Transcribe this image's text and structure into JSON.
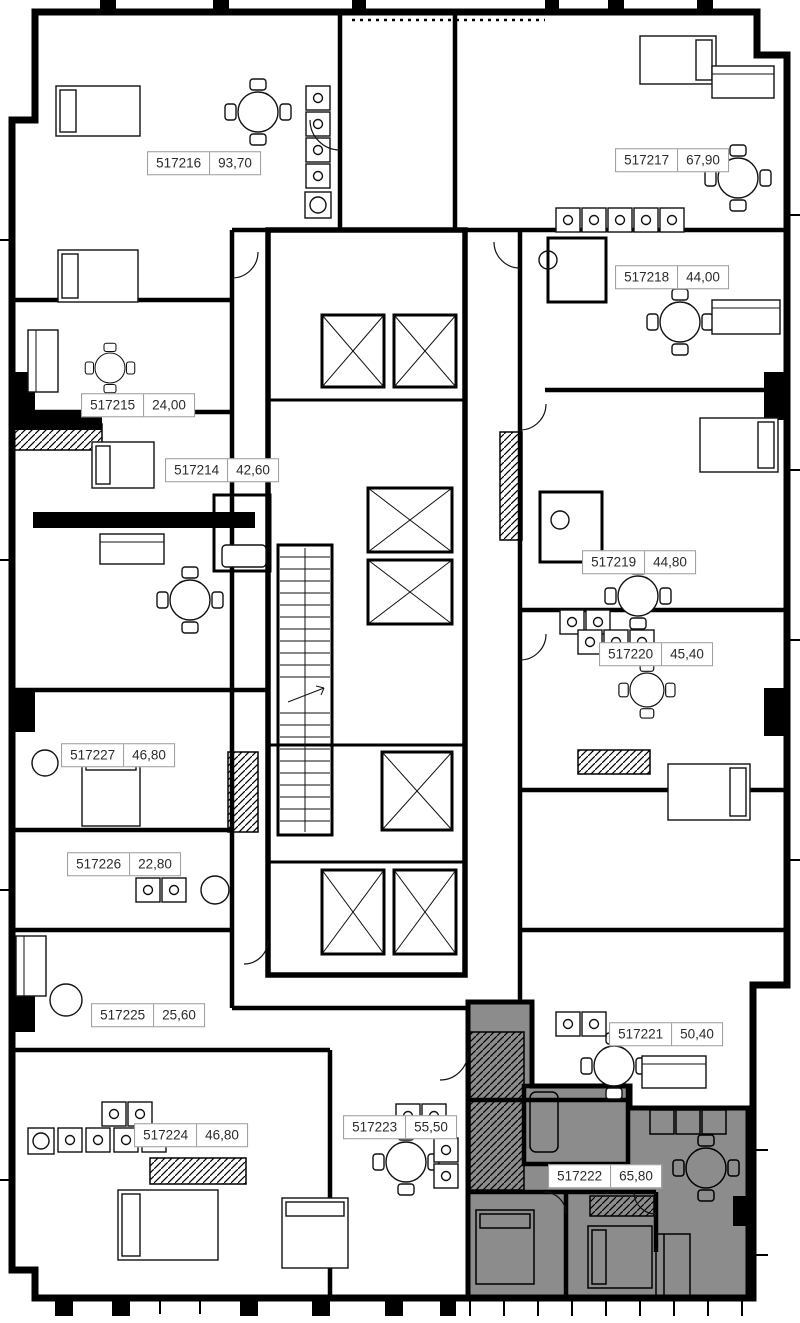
{
  "plan": {
    "selected_apartment_id": "517222",
    "colors": {
      "wall": "#000000",
      "background": "#ffffff",
      "selected_fill": "#8c8c8c",
      "label_border": "#9a9a9a",
      "label_text": "#2b2b2b"
    },
    "apartments": [
      {
        "id": "517216",
        "area": "93,70",
        "selected": false
      },
      {
        "id": "517217",
        "area": "67,90",
        "selected": false
      },
      {
        "id": "517218",
        "area": "44,00",
        "selected": false
      },
      {
        "id": "517215",
        "area": "24,00",
        "selected": false
      },
      {
        "id": "517214",
        "area": "42,60",
        "selected": false
      },
      {
        "id": "517219",
        "area": "44,80",
        "selected": false
      },
      {
        "id": "517220",
        "area": "45,40",
        "selected": false
      },
      {
        "id": "517227",
        "area": "46,80",
        "selected": false
      },
      {
        "id": "517226",
        "area": "22,80",
        "selected": false
      },
      {
        "id": "517225",
        "area": "25,60",
        "selected": false
      },
      {
        "id": "517221",
        "area": "50,40",
        "selected": false
      },
      {
        "id": "517224",
        "area": "46,80",
        "selected": false
      },
      {
        "id": "517223",
        "area": "55,50",
        "selected": false
      },
      {
        "id": "517222",
        "area": "65,80",
        "selected": true
      }
    ]
  }
}
